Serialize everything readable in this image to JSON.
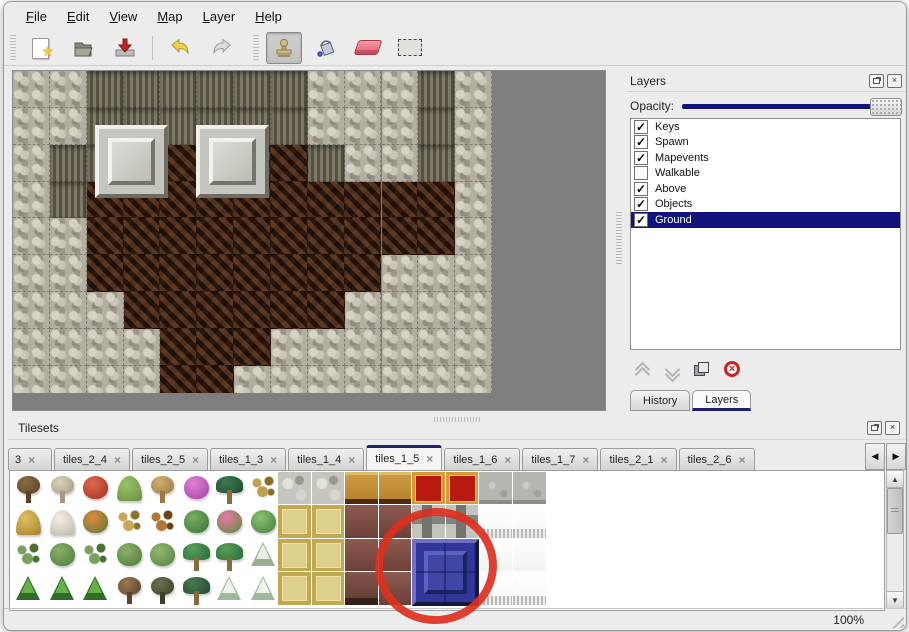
{
  "menu": {
    "items": [
      "File",
      "Edit",
      "View",
      "Map",
      "Layer",
      "Help"
    ]
  },
  "toolbar": {
    "buttons": [
      "new-file",
      "open-file",
      "save-file",
      "undo",
      "redo",
      "stamp-tool",
      "fill-tool",
      "eraser-tool",
      "select-tool"
    ],
    "active_tool": "stamp-tool"
  },
  "layers_panel": {
    "title": "Layers",
    "opacity_label": "Opacity:",
    "layers": [
      {
        "name": "Keys",
        "checked": true,
        "selected": false
      },
      {
        "name": "Spawn",
        "checked": true,
        "selected": false
      },
      {
        "name": "Mapevents",
        "checked": true,
        "selected": false
      },
      {
        "name": "Walkable",
        "checked": false,
        "selected": false
      },
      {
        "name": "Above",
        "checked": true,
        "selected": false
      },
      {
        "name": "Objects",
        "checked": true,
        "selected": false
      },
      {
        "name": "Ground",
        "checked": true,
        "selected": true
      }
    ],
    "dock_tabs": [
      {
        "label": "History",
        "active": false
      },
      {
        "label": "Layers",
        "active": true
      }
    ]
  },
  "tilesets_panel": {
    "title": "Tilesets",
    "tabs": [
      {
        "label": "3",
        "active": false,
        "first": true
      },
      {
        "label": "tiles_2_4",
        "active": false
      },
      {
        "label": "tiles_2_5",
        "active": false
      },
      {
        "label": "tiles_1_3",
        "active": false
      },
      {
        "label": "tiles_1_4",
        "active": false
      },
      {
        "label": "tiles_1_5",
        "active": true
      },
      {
        "label": "tiles_1_6",
        "active": false
      },
      {
        "label": "tiles_1_7",
        "active": false
      },
      {
        "label": "tiles_2_1",
        "active": false
      },
      {
        "label": "tiles_2_6",
        "active": false
      }
    ]
  },
  "statusbar": {
    "zoom": "100%"
  },
  "glyphs": {
    "close": "×",
    "check": "✓",
    "tab_close": "×",
    "star": "★",
    "scroll_up": "▲",
    "scroll_down": "▼",
    "tab_prev": "◀",
    "tab_next": "▶"
  },
  "colors": {
    "selection_navy": "#13137d",
    "tab_accent_navy": "#23246a",
    "annotation_red": "#dd3020"
  },
  "map": {
    "tile_size": 36.85,
    "legend": {
      "L": "light-rock",
      "D": "dark-cliff",
      "F": "brown-floor"
    },
    "grid": [
      "LLDDDDDDLLLDL",
      "LLDDDDDDLLLDL",
      "LDDFFFFFDLLDL",
      "LDFFFFFFFFFFL",
      "LLFFFFFFFFFFL",
      "LLFFFFFFFFLLL",
      "LLLFFFFFFLLLL",
      "LLLLFFFLLLLLL",
      "LLLLFFLLLLLLL"
    ],
    "platforms": [
      {
        "x": 82,
        "y": 54
      },
      {
        "x": 183,
        "y": 54
      }
    ]
  },
  "palette": {
    "tile_size": 33.5,
    "nature_tiles": [
      [
        {
          "shape": "tree",
          "c1": "#8a6a42",
          "c2": "#5a4228"
        },
        {
          "shape": "tree",
          "c1": "#d8cfba",
          "c2": "#a89a80"
        },
        {
          "shape": "blob",
          "c1": "#e06a4a",
          "c2": "#a03020"
        },
        {
          "shape": "mound",
          "c1": "#9cc068",
          "c2": "#6a9040"
        },
        {
          "shape": "tree",
          "c1": "#d0b070",
          "c2": "#9a7a40"
        },
        {
          "shape": "blob",
          "c1": "#e080d8",
          "c2": "#a040a0"
        },
        {
          "shape": "palm",
          "c1": "#3a7a50",
          "c2": "#1f4a30"
        },
        {
          "shape": "sprig",
          "c1": "#c0a050",
          "c2": "#8a6a28"
        }
      ],
      [
        {
          "shape": "mound",
          "c1": "#e0c060",
          "c2": "#a08030"
        },
        {
          "shape": "mound",
          "c1": "#f2efe6",
          "c2": "#c0b8a8"
        },
        {
          "shape": "blob",
          "c1": "#e08840",
          "c2": "#5a7a30"
        },
        {
          "shape": "sprig",
          "c1": "#c8a858",
          "c2": "#907030"
        },
        {
          "shape": "sprig",
          "c1": "#b07838",
          "c2": "#6a4218"
        },
        {
          "shape": "blob",
          "c1": "#7ab060",
          "c2": "#3a7034"
        },
        {
          "shape": "blob",
          "c1": "#e87aa8",
          "c2": "#5a8a3a"
        },
        {
          "shape": "blob",
          "c1": "#88c070",
          "c2": "#468040"
        }
      ],
      [
        {
          "shape": "sprig",
          "c1": "#7aa060",
          "c2": "#4a7038"
        },
        {
          "shape": "blob",
          "c1": "#8ab068",
          "c2": "#4e7a3c"
        },
        {
          "shape": "sprig",
          "c1": "#7aa060",
          "c2": "#4a7038"
        },
        {
          "shape": "blob",
          "c1": "#8ab068",
          "c2": "#4e7a3c"
        },
        {
          "shape": "blob",
          "c1": "#90b870",
          "c2": "#558040"
        },
        {
          "shape": "palm",
          "c1": "#58a058",
          "c2": "#2a6a3a"
        },
        {
          "shape": "palm",
          "c1": "#58a058",
          "c2": "#2a6a3a"
        },
        {
          "shape": "conifer",
          "c1": "#e8f0e4",
          "c2": "#9ab090"
        }
      ],
      [
        {
          "shape": "conifer",
          "c1": "#6ab048",
          "c2": "#2e6e28"
        },
        {
          "shape": "conifer",
          "c1": "#6ab048",
          "c2": "#2e6e28"
        },
        {
          "shape": "conifer",
          "c1": "#6ab048",
          "c2": "#2e6e28"
        },
        {
          "shape": "tree",
          "c1": "#9a7a50",
          "c2": "#5a4228"
        },
        {
          "shape": "tree",
          "c1": "#6a7050",
          "c2": "#3a4028"
        },
        {
          "shape": "palm",
          "c1": "#4a7a50",
          "c2": "#234a30"
        },
        {
          "shape": "conifer",
          "c1": "#eef4ea",
          "c2": "#a0b8a0"
        },
        {
          "shape": "conifer",
          "c1": "#eef4ea",
          "c2": "#a0b8a0"
        }
      ]
    ],
    "structured_tiles": [
      {
        "x": 268,
        "y": 1,
        "w": 33,
        "h": 33,
        "cls": "stone"
      },
      {
        "x": 302,
        "y": 1,
        "w": 33,
        "h": 33,
        "cls": "stone"
      },
      {
        "x": 335,
        "y": 1,
        "w": 33,
        "h": 33,
        "cls": "wood"
      },
      {
        "x": 369,
        "y": 1,
        "w": 33,
        "h": 33,
        "cls": "wood"
      },
      {
        "x": 402,
        "y": 1,
        "w": 33,
        "h": 33,
        "cls": "redcarpet"
      },
      {
        "x": 436,
        "y": 1,
        "w": 33,
        "h": 33,
        "cls": "redcarpet"
      },
      {
        "x": 469,
        "y": 1,
        "w": 33,
        "h": 33,
        "cls": "graystone"
      },
      {
        "x": 503,
        "y": 1,
        "w": 33,
        "h": 33,
        "cls": "graystone"
      },
      {
        "x": 268,
        "y": 34,
        "w": 33,
        "h": 33,
        "cls": "tancarpet"
      },
      {
        "x": 302,
        "y": 34,
        "w": 33,
        "h": 33,
        "cls": "tancarpet"
      },
      {
        "x": 335,
        "y": 34,
        "w": 33,
        "h": 33,
        "cls": "brown"
      },
      {
        "x": 369,
        "y": 34,
        "w": 33,
        "h": 33,
        "cls": "brown"
      },
      {
        "x": 402,
        "y": 34,
        "w": 33,
        "h": 33,
        "cls": "metal"
      },
      {
        "x": 436,
        "y": 34,
        "w": 33,
        "h": 33,
        "cls": "metal"
      },
      {
        "x": 469,
        "y": 34,
        "w": 33,
        "h": 33,
        "cls": "whitefringe"
      },
      {
        "x": 503,
        "y": 34,
        "w": 33,
        "h": 33,
        "cls": "whitefringe"
      },
      {
        "x": 268,
        "y": 68,
        "w": 33,
        "h": 33,
        "cls": "tancarpet"
      },
      {
        "x": 302,
        "y": 68,
        "w": 33,
        "h": 33,
        "cls": "tancarpet"
      },
      {
        "x": 335,
        "y": 68,
        "w": 33,
        "h": 33,
        "cls": "brown"
      },
      {
        "x": 369,
        "y": 68,
        "w": 33,
        "h": 33,
        "cls": "brown"
      },
      {
        "x": 469,
        "y": 68,
        "w": 33,
        "h": 33,
        "cls": "white"
      },
      {
        "x": 503,
        "y": 68,
        "w": 33,
        "h": 33,
        "cls": "white"
      },
      {
        "x": 268,
        "y": 101,
        "w": 33,
        "h": 33,
        "cls": "tancarpet"
      },
      {
        "x": 302,
        "y": 101,
        "w": 33,
        "h": 33,
        "cls": "tancarpet"
      },
      {
        "x": 335,
        "y": 101,
        "w": 33,
        "h": 33,
        "cls": "browndark"
      },
      {
        "x": 369,
        "y": 101,
        "w": 33,
        "h": 33,
        "cls": "brown"
      },
      {
        "x": 469,
        "y": 101,
        "w": 33,
        "h": 33,
        "cls": "whitefringe"
      },
      {
        "x": 503,
        "y": 101,
        "w": 33,
        "h": 33,
        "cls": "whitefringe"
      }
    ],
    "selected_tile": {
      "x": 402,
      "y": 68,
      "w": 67,
      "h": 67,
      "cls": "bluetile"
    }
  },
  "annotation": {
    "circle": {
      "x": 374,
      "y": 507,
      "w": 124,
      "h": 118
    }
  }
}
